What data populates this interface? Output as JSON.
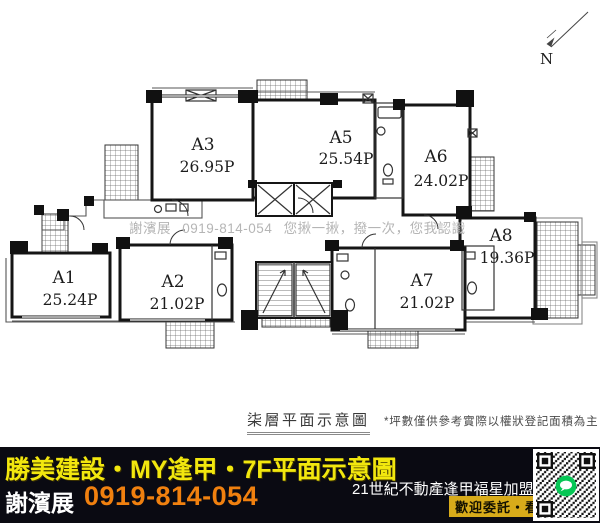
{
  "plan": {
    "caption": "柒層平面示意圖",
    "disclaimer": "*坪數僅供參考實際以權狀登記面積為主",
    "watermark": "謝濱展 0919-814-054 您揪一揪，撥一次，您我認識",
    "north_label": "N",
    "units": [
      {
        "id": "A1",
        "area": "25.24P"
      },
      {
        "id": "A2",
        "area": "21.02P"
      },
      {
        "id": "A3",
        "area": "26.95P"
      },
      {
        "id": "A5",
        "area": "25.54P"
      },
      {
        "id": "A6",
        "area": "24.02P"
      },
      {
        "id": "A7",
        "area": "21.02P"
      },
      {
        "id": "A8",
        "area": "19.36P"
      }
    ]
  },
  "footer": {
    "headline": "勝美建設・MY逢甲・7F平面示意圖",
    "agent_name": "謝濱展",
    "phone": "0919-814-054",
    "agency": "21世紀不動產逢甲福星加盟店",
    "badge": "歡迎委託・看屋"
  },
  "icons": {
    "north_arrow": "north-arrow-icon",
    "qr": "qr-code",
    "line_logo": "line-logo-icon"
  },
  "colors": {
    "banner_bg": "#0a0a12",
    "headline_yellow": "#f2e70e",
    "phone_orange": "#f0800f",
    "badge_yellow": "#d8ab1a",
    "watermark_gray": "#b5b5b5",
    "line_green": "#06c755"
  }
}
